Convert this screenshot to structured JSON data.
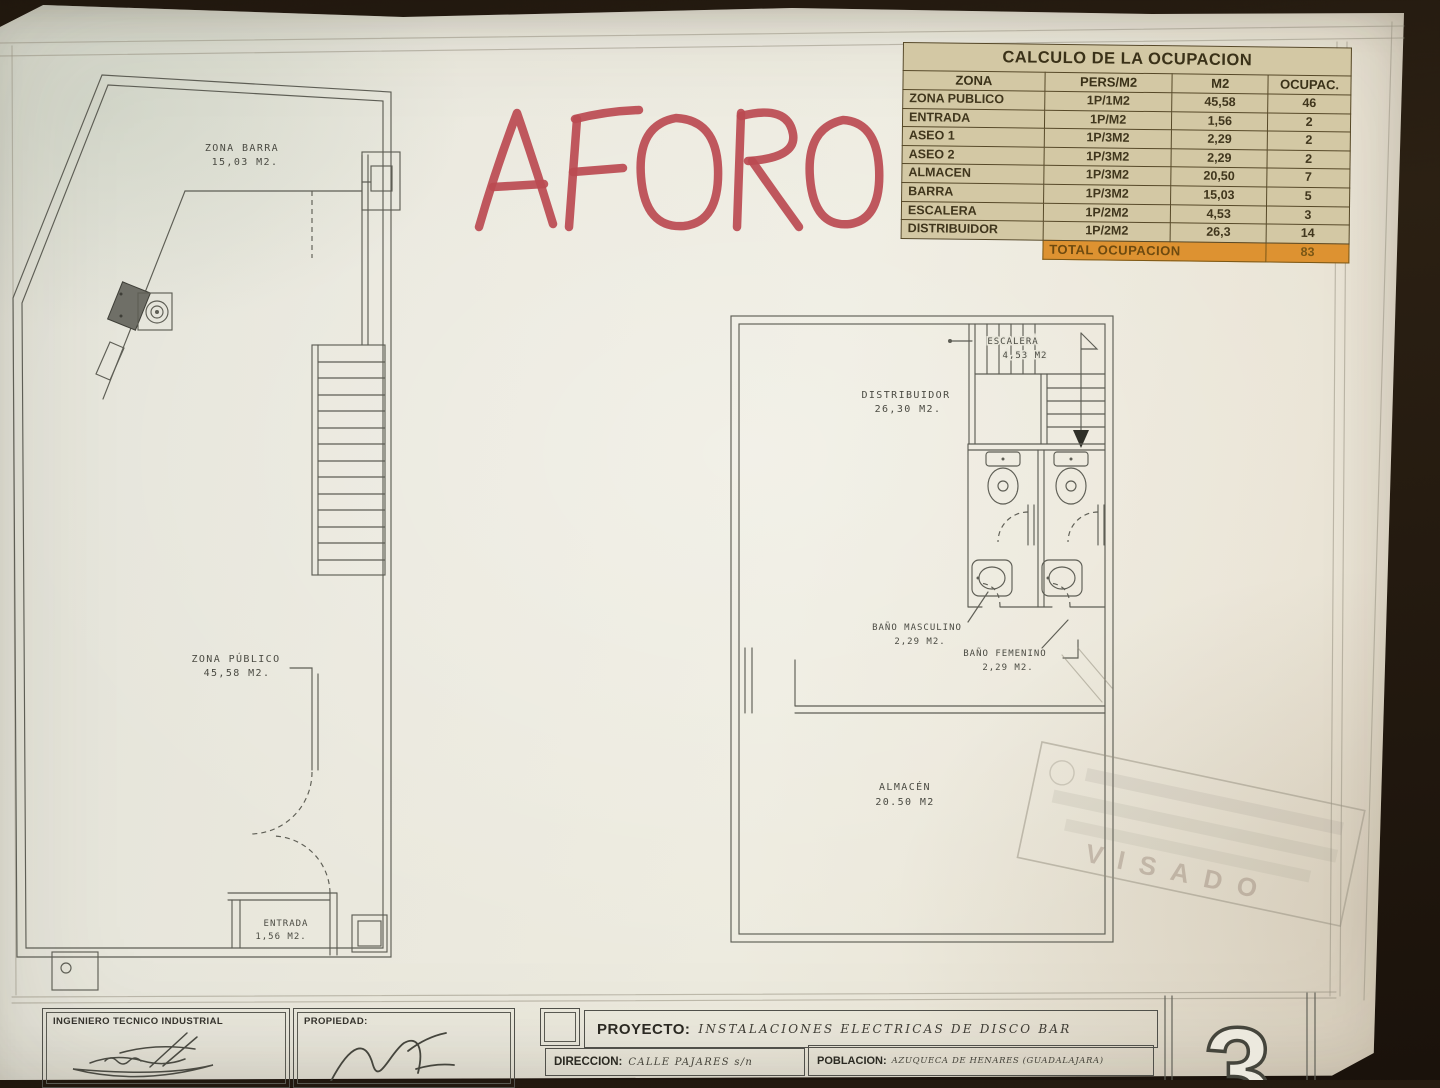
{
  "annotation": {
    "text": "AFORO",
    "color": "#bb4a51"
  },
  "occupancy_table": {
    "title": "CALCULO DE LA OCUPACION",
    "headers": [
      "ZONA",
      "PERS/M2",
      "M2",
      "OCUPAC."
    ],
    "rows": [
      [
        "ZONA PUBLICO",
        "1P/1M2",
        "45,58",
        "46"
      ],
      [
        "ENTRADA",
        "1P/M2",
        "1,56",
        "2"
      ],
      [
        "ASEO 1",
        "1P/3M2",
        "2,29",
        "2"
      ],
      [
        "ASEO 2",
        "1P/3M2",
        "2,29",
        "2"
      ],
      [
        "ALMACEN",
        "1P/3M2",
        "20,50",
        "7"
      ],
      [
        "BARRA",
        "1P/3M2",
        "15,03",
        "5"
      ],
      [
        "ESCALERA",
        "1P/2M2",
        "4,53",
        "3"
      ],
      [
        "DISTRIBUIDOR",
        "1P/2M2",
        "26,3",
        "14"
      ]
    ],
    "total_label": "TOTAL OCUPACION",
    "total_value": "83"
  },
  "floor_plan_left": {
    "zona_barra": {
      "label": "ZONA BARRA",
      "area": "15,03 M2."
    },
    "zona_publico": {
      "label": "ZONA PÚBLICO",
      "area": "45,58 M2."
    },
    "entrada": {
      "label": "ENTRADA",
      "area": "1,56 M2."
    }
  },
  "floor_plan_right": {
    "escalera": {
      "label": "ESCALERA",
      "area": "4,53 M2"
    },
    "distribuidor": {
      "label": "DISTRIBUIDOR",
      "area": "26,30 M2."
    },
    "bano_masculino": {
      "label": "BAÑO MASCULINO",
      "area": "2,29 M2."
    },
    "bano_femenino": {
      "label": "BAÑO FEMENINO",
      "area": "2,29 M2."
    },
    "almacen": {
      "label": "ALMACÉN",
      "area": "20.50 M2"
    }
  },
  "stamp": {
    "text": "VISADO"
  },
  "title_block": {
    "engineer_label": "INGENIERO TECNICO INDUSTRIAL",
    "property_label": "PROPIEDAD:",
    "project_label": "PROYECTO:",
    "project_value": "INSTALACIONES ELECTRICAS DE DISCO BAR",
    "address_label": "DIRECCION:",
    "address_value": "CALLE PAJARES s/n",
    "town_label": "POBLACION:",
    "town_value": "AZUQUECA DE HENARES (GUADALAJARA)",
    "sheet_number": "3"
  },
  "colors": {
    "paper": "#e9e6db",
    "aforo_red": "#bb4a51",
    "table_background": "#d3c8a4",
    "table_total_orange": "#dd9231",
    "ink": "#5e5e55"
  }
}
